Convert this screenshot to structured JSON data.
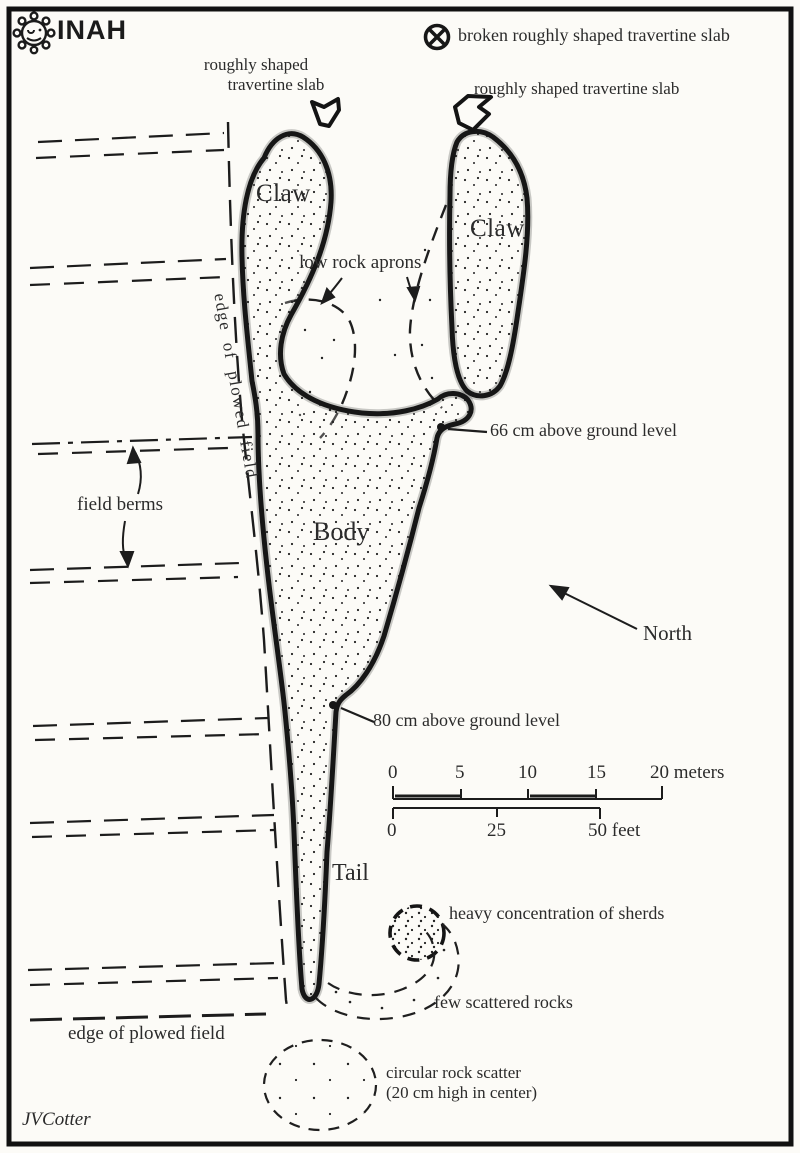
{
  "page": {
    "paper_color": "#fcfbf7",
    "ink_color": "#1f1f1f",
    "title_semantic": "archaeological site plan of scorpion-shaped mound"
  },
  "header": {
    "logo_text": "INAH",
    "legend": {
      "icon": "circle-x-icon",
      "label": "broken roughly shaped travertine slab"
    }
  },
  "labels": {
    "slab_left_line1": "roughly shaped",
    "slab_left_line2": "travertine slab",
    "slab_right": "roughly shaped travertine slab",
    "claw_left": "Claw",
    "claw_right": "Claw",
    "low_rock_aprons": "low rock aprons",
    "elev_66": "66 cm above ground level",
    "field_berms": "field berms",
    "edge_plowed_vertical": "edge of plowed field",
    "body": "Body",
    "north": "North",
    "elev_80": "80 cm above ground level",
    "tail": "Tail",
    "sherds": "heavy concentration of sherds",
    "scattered_rocks": "few scattered rocks",
    "edge_plowed_bottom": "edge of plowed field",
    "rock_scatter_line1": "circular rock scatter",
    "rock_scatter_line2": "(20 cm high in center)",
    "credit": "JVCotter"
  },
  "scale_bars": {
    "meters": {
      "ticks": [
        "0",
        "5",
        "10",
        "15"
      ],
      "end_label": "20 meters"
    },
    "feet": {
      "ticks": [
        "0",
        "25"
      ],
      "end_label": "50 feet"
    }
  }
}
